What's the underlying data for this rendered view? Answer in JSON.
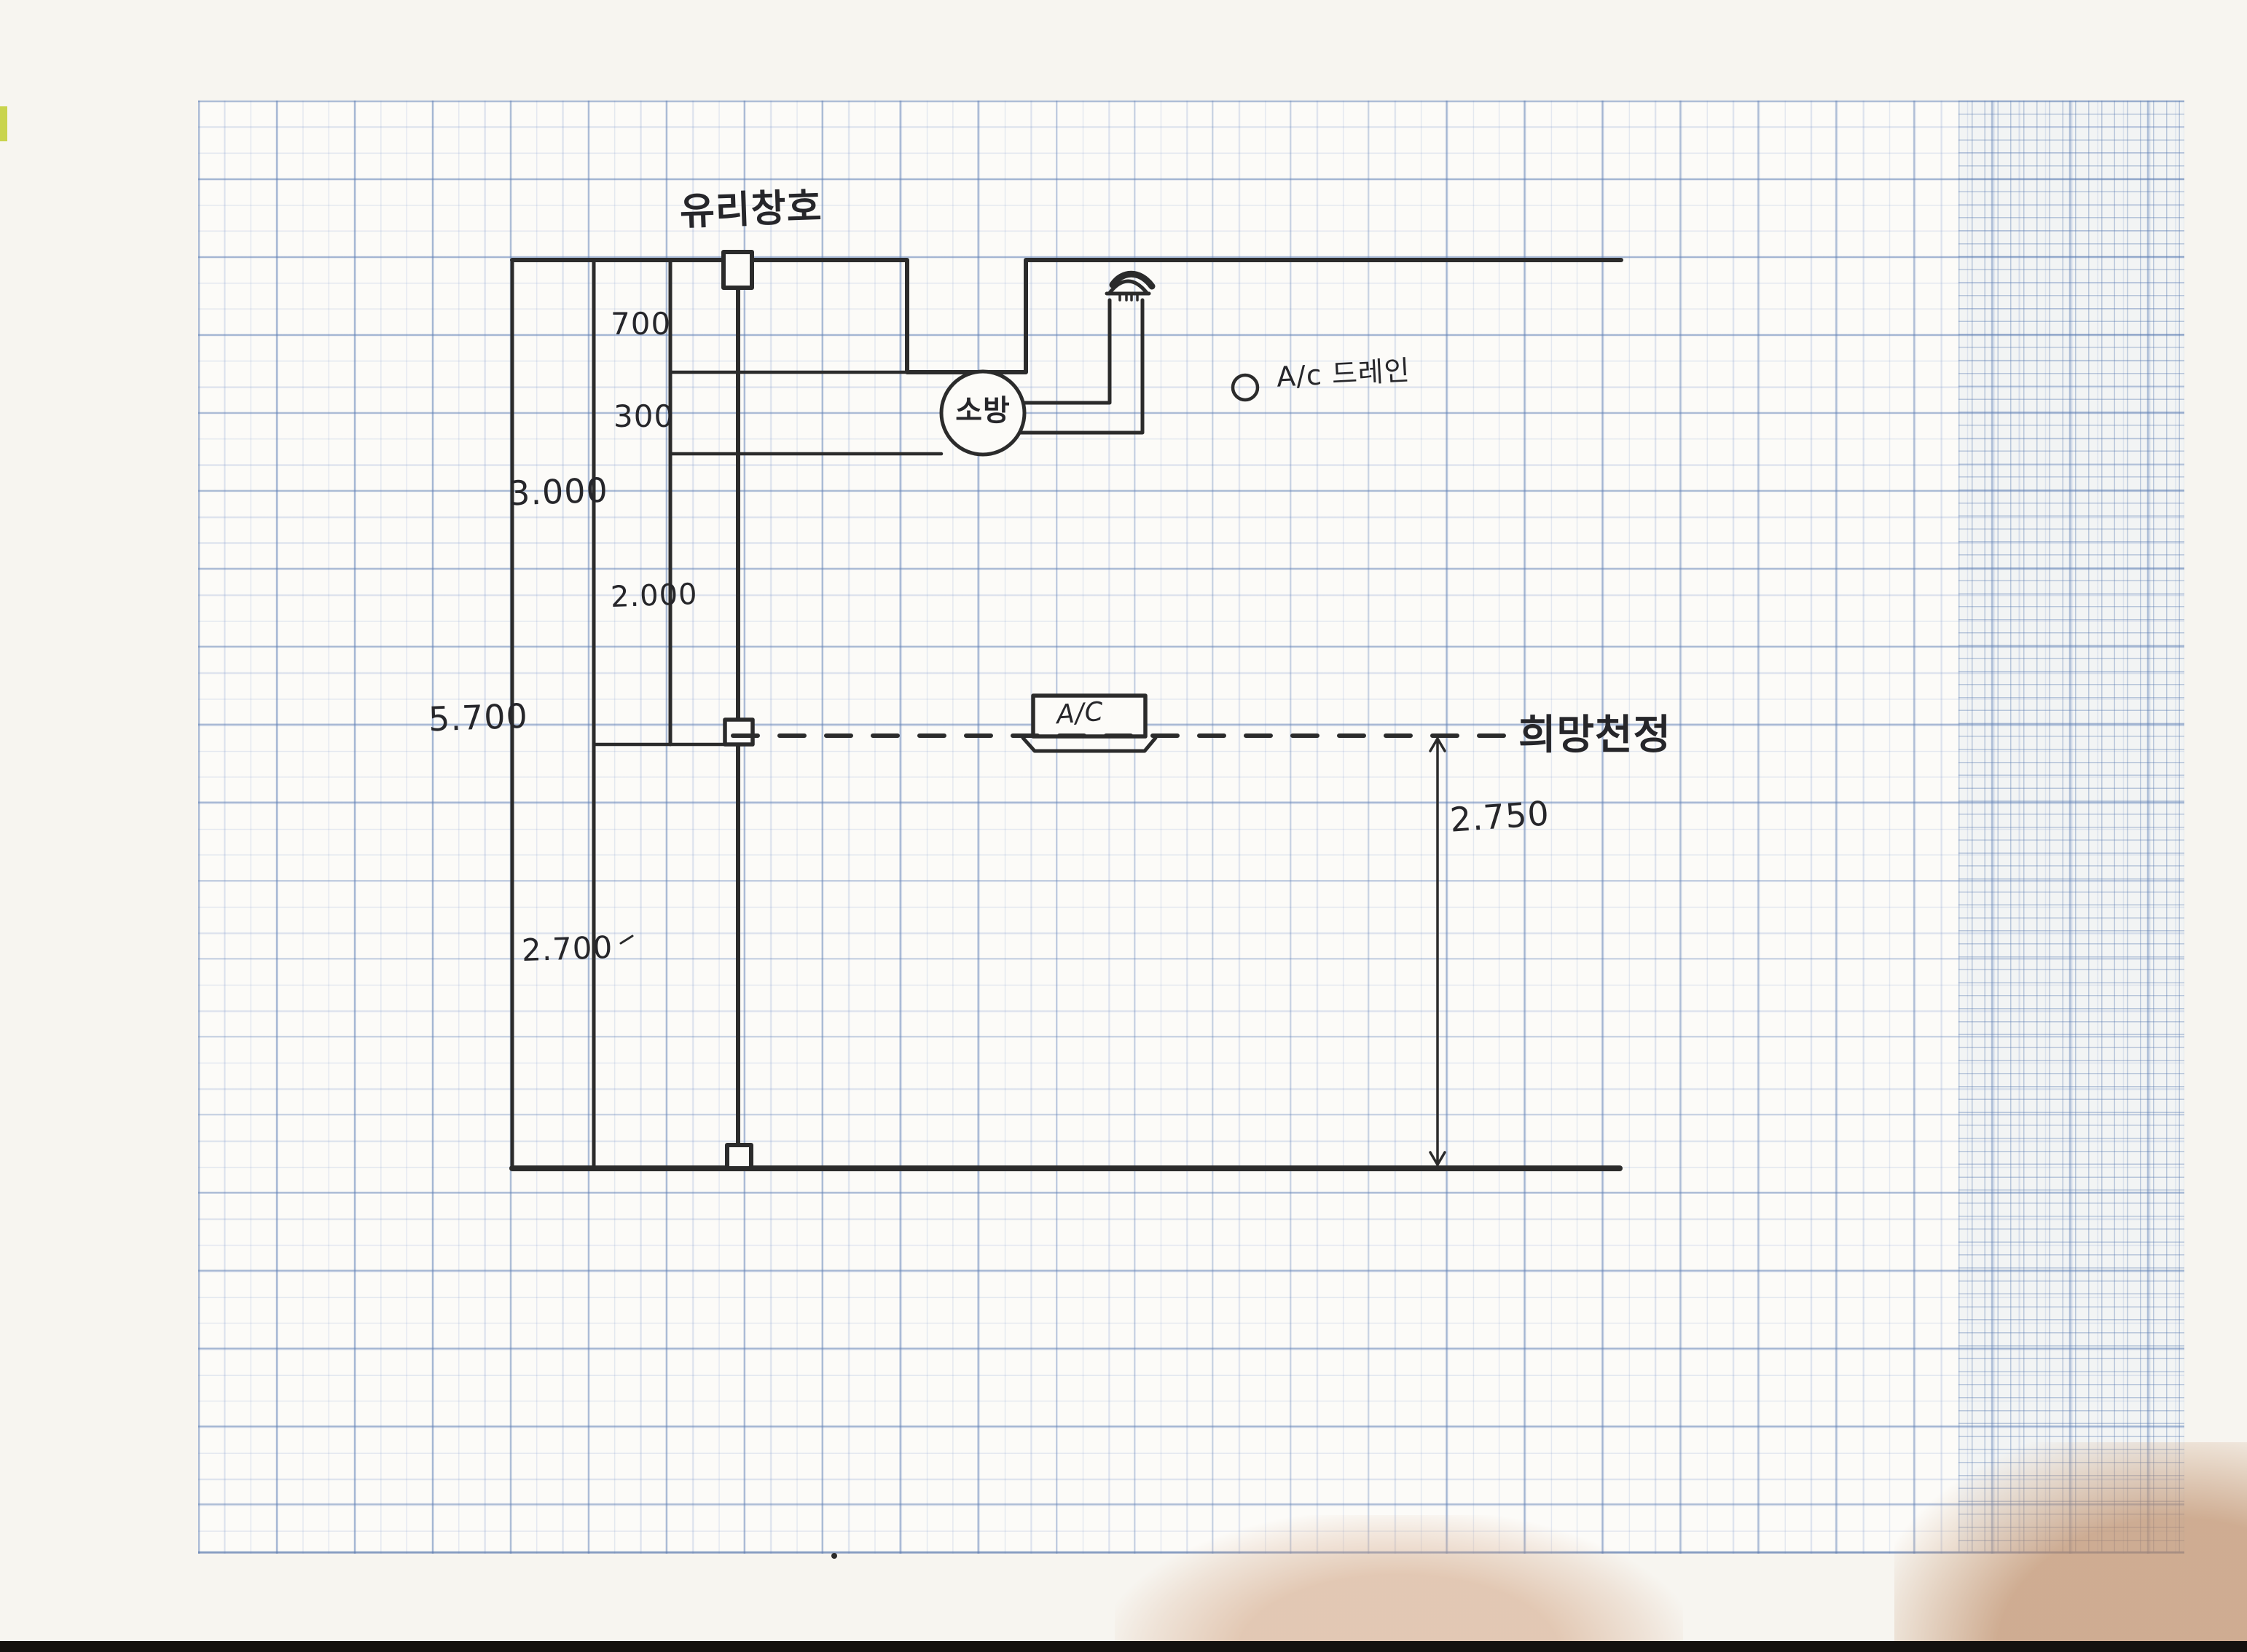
{
  "colors": {
    "ink": "#2b2b2b",
    "paper": "#f7f5f0",
    "grid_paper": "#fcfbf8",
    "grid_minor": "#aec2de",
    "grid_major": "#6080b4",
    "shadow_tan": "#d6ad8f",
    "shadow_brown": "#ba8761",
    "scan_bar_black": "#14110f",
    "edge_mark_green": "#c9d44d"
  },
  "labels": {
    "glass_window": "유리창호",
    "fire": "소방",
    "ac_unit": "A/C",
    "ac_drain": "A/c 드레인",
    "desired_ceiling": "희망천정"
  },
  "dimensions": {
    "d700": "700",
    "d300": "300",
    "d3000": "3.000",
    "d2000": "2.000",
    "d5700": "5.700",
    "d2700": "2.700",
    "d2750": "2.750"
  }
}
